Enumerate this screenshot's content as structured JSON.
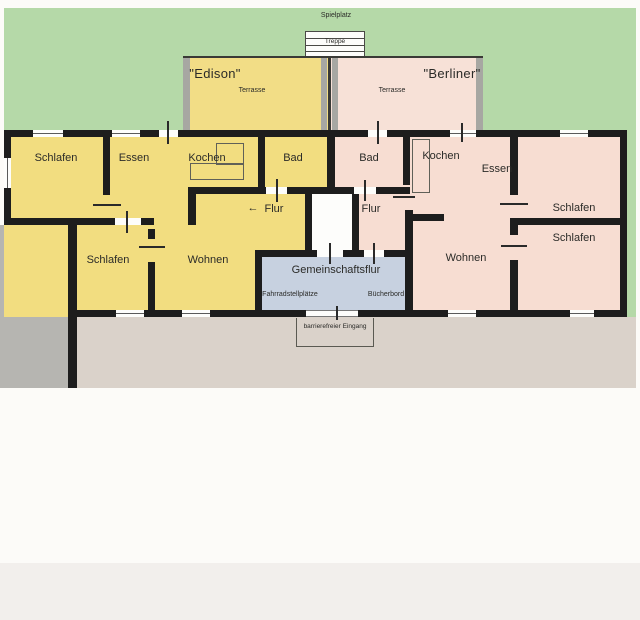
{
  "site": {
    "playground": "Spielplatz",
    "stairs": "Treppe",
    "entrance_note": "barrierefreier Eingang"
  },
  "shared_hall": {
    "title": "Gemeinschaftsflur",
    "bike_parking": "Fahrradstellplätze",
    "bookshelf": "Bücherbord"
  },
  "edison": {
    "name": "\"Edison\"",
    "terrace": "Terrasse",
    "rooms": {
      "schlafen1": "Schlafen",
      "essen": "Essen",
      "kochen": "Kochen",
      "bad": "Bad",
      "flur": "Flur",
      "flur_arrow": "←",
      "schlafen2": "Schlafen",
      "wohnen": "Wohnen"
    }
  },
  "berliner": {
    "name": "\"Berliner\"",
    "terrace": "Terrasse",
    "rooms": {
      "bad": "Bad",
      "kochen": "Kochen",
      "essen": "Essen",
      "flur": "Flur",
      "wohnen": "Wohnen",
      "schlafen1": "Schlafen",
      "schlafen2": "Schlafen"
    }
  },
  "colors": {
    "lawn_green": "#b5d9a8",
    "edison_yellow": "#f2dd80",
    "berliner_peach": "#f7ddd2",
    "shared_hall_blue": "#c7d1e0",
    "driveway_gray": "#b6b5b1",
    "yard_tan": "#dad2ca",
    "wall_black": "#1d1d1d"
  }
}
